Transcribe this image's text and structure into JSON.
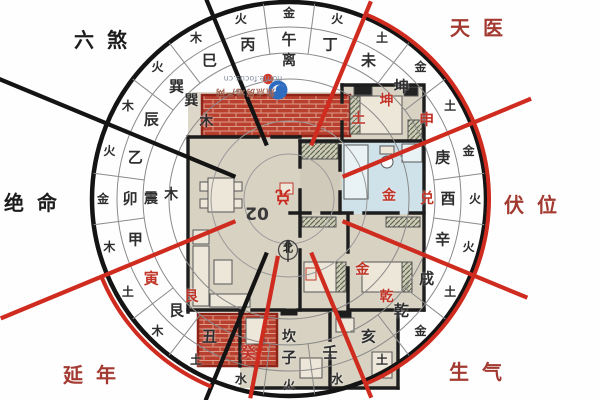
{
  "compass": {
    "center": {
      "x": 289,
      "y": 199
    },
    "mountains": [
      "午",
      "丁",
      "未",
      "坤",
      "申",
      "庚",
      "酉",
      "辛",
      "戌",
      "乾",
      "亥",
      "壬",
      "子",
      "癸",
      "丑",
      "艮",
      "寅",
      "甲",
      "卯",
      "乙",
      "辰",
      "巽",
      "巳",
      "丙"
    ],
    "red_mountains": [
      "申",
      "癸",
      "寅"
    ],
    "elements": [
      "金",
      "火",
      "土",
      "金",
      "土",
      "金",
      "火",
      "火",
      "土",
      "金",
      "土",
      "水",
      "火",
      "水",
      "土",
      "木",
      "土",
      "木",
      "金",
      "火",
      "木",
      "火",
      "木",
      "火"
    ],
    "trigrams": [
      {
        "label": "离",
        "color": "black"
      },
      {
        "label": "坤",
        "color": "red"
      },
      {
        "label": "兑",
        "color": "red"
      },
      {
        "label": "乾",
        "color": "red"
      },
      {
        "label": "坎",
        "color": "black"
      },
      {
        "label": "艮",
        "color": "red"
      },
      {
        "label": "震",
        "color": "black"
      },
      {
        "label": "巽",
        "color": "black"
      }
    ],
    "companions": [
      {
        "label": "土",
        "angle": 41,
        "r": 106,
        "color": "red"
      },
      {
        "label": "金",
        "angle": 88,
        "r": 100,
        "color": "red"
      },
      {
        "label": "金",
        "angle": 134,
        "r": 102,
        "color": "red"
      },
      {
        "label": "木",
        "angle": 313,
        "r": 113,
        "color": "black"
      },
      {
        "label": "木",
        "angle": 272,
        "r": 118,
        "color": "black"
      }
    ]
  },
  "sectors": {
    "liu_sha": "六煞",
    "tian_yi": "天医",
    "fu_wei": "伏位",
    "sheng_qi": "生气",
    "yan_nian": "延年",
    "jue_ming": "绝命"
  },
  "plan": {
    "unit_number": "02",
    "house_gua_stamp": "兑",
    "north_label": "北"
  },
  "watermark": {
    "url": "home.focus.cn",
    "site": "焦点房地产网"
  },
  "colors": {
    "red_line": "#cf2b1f",
    "dark_line": "#141414",
    "red_char": "#c13428",
    "dark_char": "#2e2e2e",
    "red_label": "#a33a31",
    "black_label": "#1c1c1c",
    "brick": "#b9402f",
    "floor": "#d8d2c3",
    "wall": "#1d1d1d",
    "bath": "#cfe2e9",
    "logo_blue": "#2e6cc0",
    "logo_red": "#d23b2c"
  }
}
